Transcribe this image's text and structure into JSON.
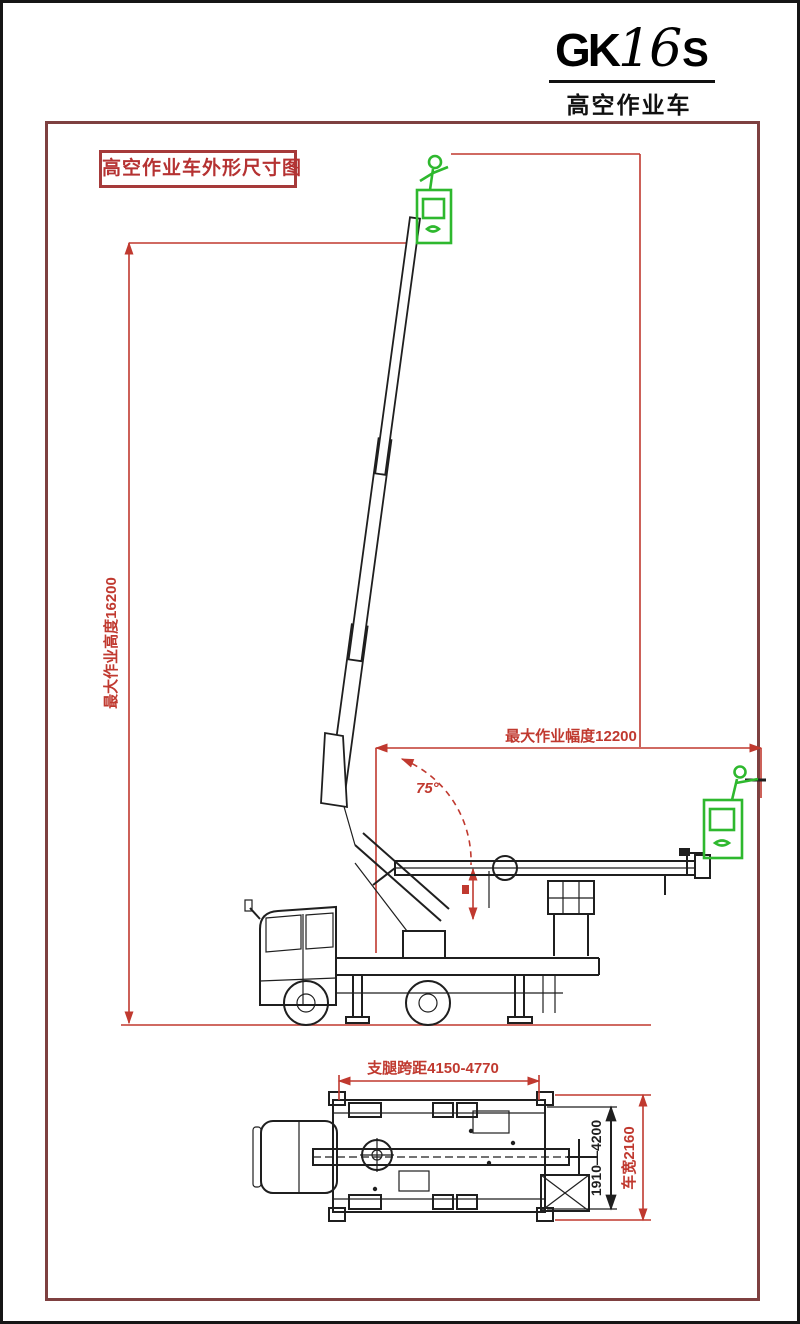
{
  "logo": {
    "model_prefix": "GK",
    "model_number": "16",
    "model_suffix": "S",
    "subtitle": "高空作业车"
  },
  "title_box": {
    "label": "高空作业车外形尺寸图"
  },
  "side_view": {
    "height_dimension_label": "最大作业高度16200",
    "radius_dimension_label": "最大作业幅度12200",
    "boom_angle_label": "75°"
  },
  "plan_view": {
    "outrigger_span_label": "支腿跨距4150-4770",
    "outrigger_lateral_label": "1910—4200",
    "vehicle_width_label": "车宽2160"
  },
  "colors": {
    "dimension_red": "#c0392f",
    "frame_red": "#7e4040",
    "title_red": "#b53232",
    "drawing_black": "#1f1f1f",
    "basket_green": "#2eb82e"
  }
}
